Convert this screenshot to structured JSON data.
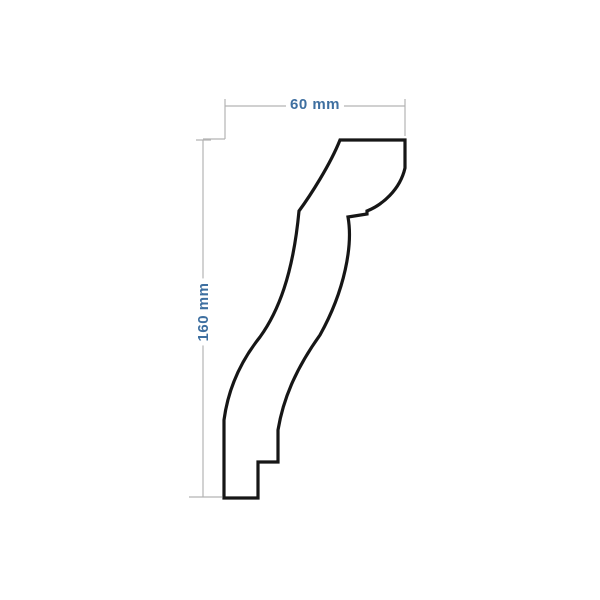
{
  "page": {
    "background_color": "#ffffff",
    "width_px": 600,
    "height_px": 600
  },
  "drawing": {
    "name": "crown-molding-profile-cross-section",
    "colors": {
      "profile_stroke": "#161616",
      "dimension_line": "#b3b3b3",
      "dimension_text": "#3e6fa0"
    },
    "profile_path": "M340,140 L405,140 L405,168 C400,190 382,205 367,211 L367,214 L348,217 C353,245 345,290 320,335 C295,370 283,400 278,430 L278,462 L258,462 L258,498 L224,498 L224,420 C228,390 240,362 260,337 C278,312 293,275 299,211 C310,196 330,165 340,140 Z",
    "dimension_path": "M225,106 H405 M225,99 V113 M405,99 V113 M225,106 V139 M203,139 H225 M196,140 H211 M203,140 V497 M189,497 H214 M203,497 H222 M405,106 V136",
    "dimensions": {
      "width": {
        "label": "60 mm",
        "orientation": "horizontal"
      },
      "height": {
        "label": "160 mm",
        "orientation": "vertical"
      }
    }
  }
}
